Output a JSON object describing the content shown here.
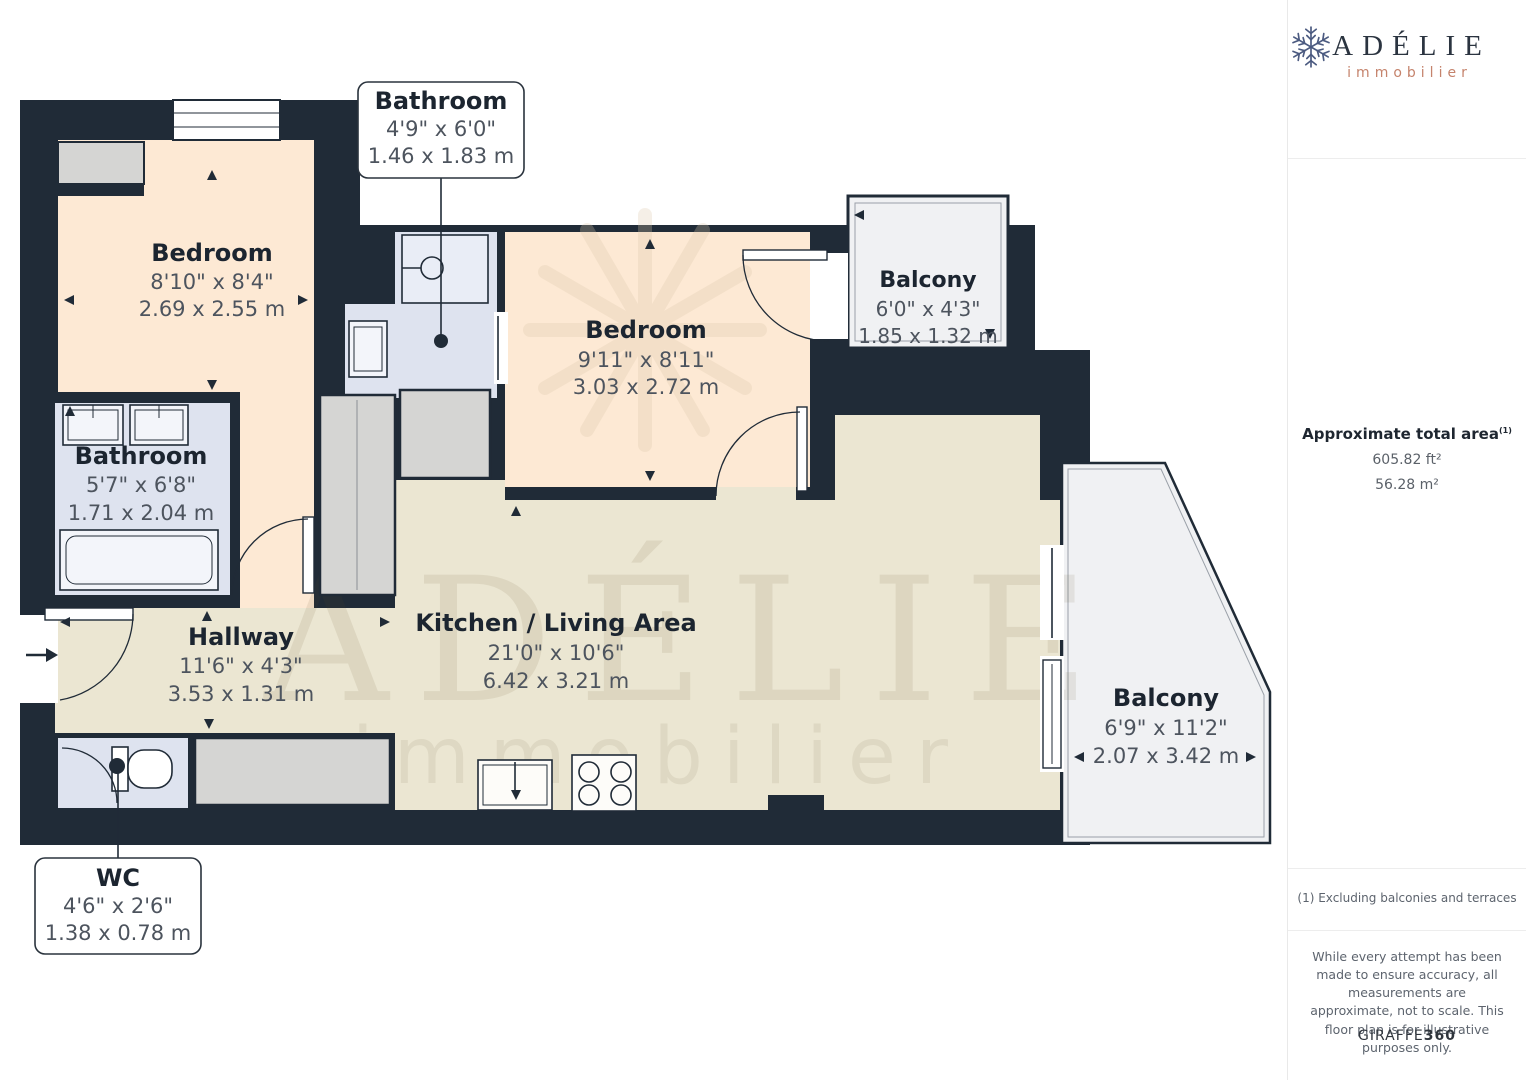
{
  "floorplan": {
    "rooms": [
      {
        "name": "Bedroom",
        "imperial": "8'10\" x 8'4\"",
        "metric": "2.69 x 2.55 m"
      },
      {
        "name": "Bedroom",
        "imperial": "9'11\" x 8'11\"",
        "metric": "3.03 x 2.72 m"
      },
      {
        "name": "Balcony",
        "imperial": "6'0\" x 4'3\"",
        "metric": "1.85 x 1.32 m"
      },
      {
        "name": "Bathroom",
        "imperial": "5'7\" x 6'8\"",
        "metric": "1.71 x 2.04 m"
      },
      {
        "name": "Hallway",
        "imperial": "11'6\" x 4'3\"",
        "metric": "3.53 x 1.31 m"
      },
      {
        "name": "Kitchen / Living Area",
        "imperial": "21'0\" x 10'6\"",
        "metric": "6.42 x 3.21 m"
      },
      {
        "name": "Balcony",
        "imperial": "6'9\" x 11'2\"",
        "metric": "2.07 x 3.42 m"
      }
    ],
    "callouts": [
      {
        "name": "Bathroom",
        "imperial": "4'9\" x 6'0\"",
        "metric": "1.46 x 1.83 m"
      },
      {
        "name": "WC",
        "imperial": "4'6\" x 2'6\"",
        "metric": "1.38 x 0.78 m"
      }
    ],
    "watermark": {
      "line1": "ADÉLIE",
      "line2": "immobilier"
    }
  },
  "sidebar": {
    "brand": {
      "name": "ADÉLIE",
      "tagline": "immobilier"
    },
    "area": {
      "label": "Approximate total area",
      "footnote_marker": "(1)",
      "imperial": "605.82 ft²",
      "metric": "56.28 m²"
    },
    "footnote": "(1) Excluding balconies and terraces",
    "disclaimer": "While every attempt has been made to ensure accuracy, all measurements are approximate, not to scale. This floor plan is for illustrative purposes only.",
    "credit": {
      "brand": "GIRAFFE",
      "suffix": "360"
    }
  },
  "colors": {
    "wall": "#202b37",
    "bedroom_fill": "#fde9d4",
    "bathroom_fill": "#dee3ef",
    "living_fill": "#ebe6d2",
    "balcony_fill": "#f0f1f3",
    "furniture_fill": "#d5d5d3",
    "brand_navy": "#2b3440",
    "brand_salmon": "#c5836c"
  }
}
